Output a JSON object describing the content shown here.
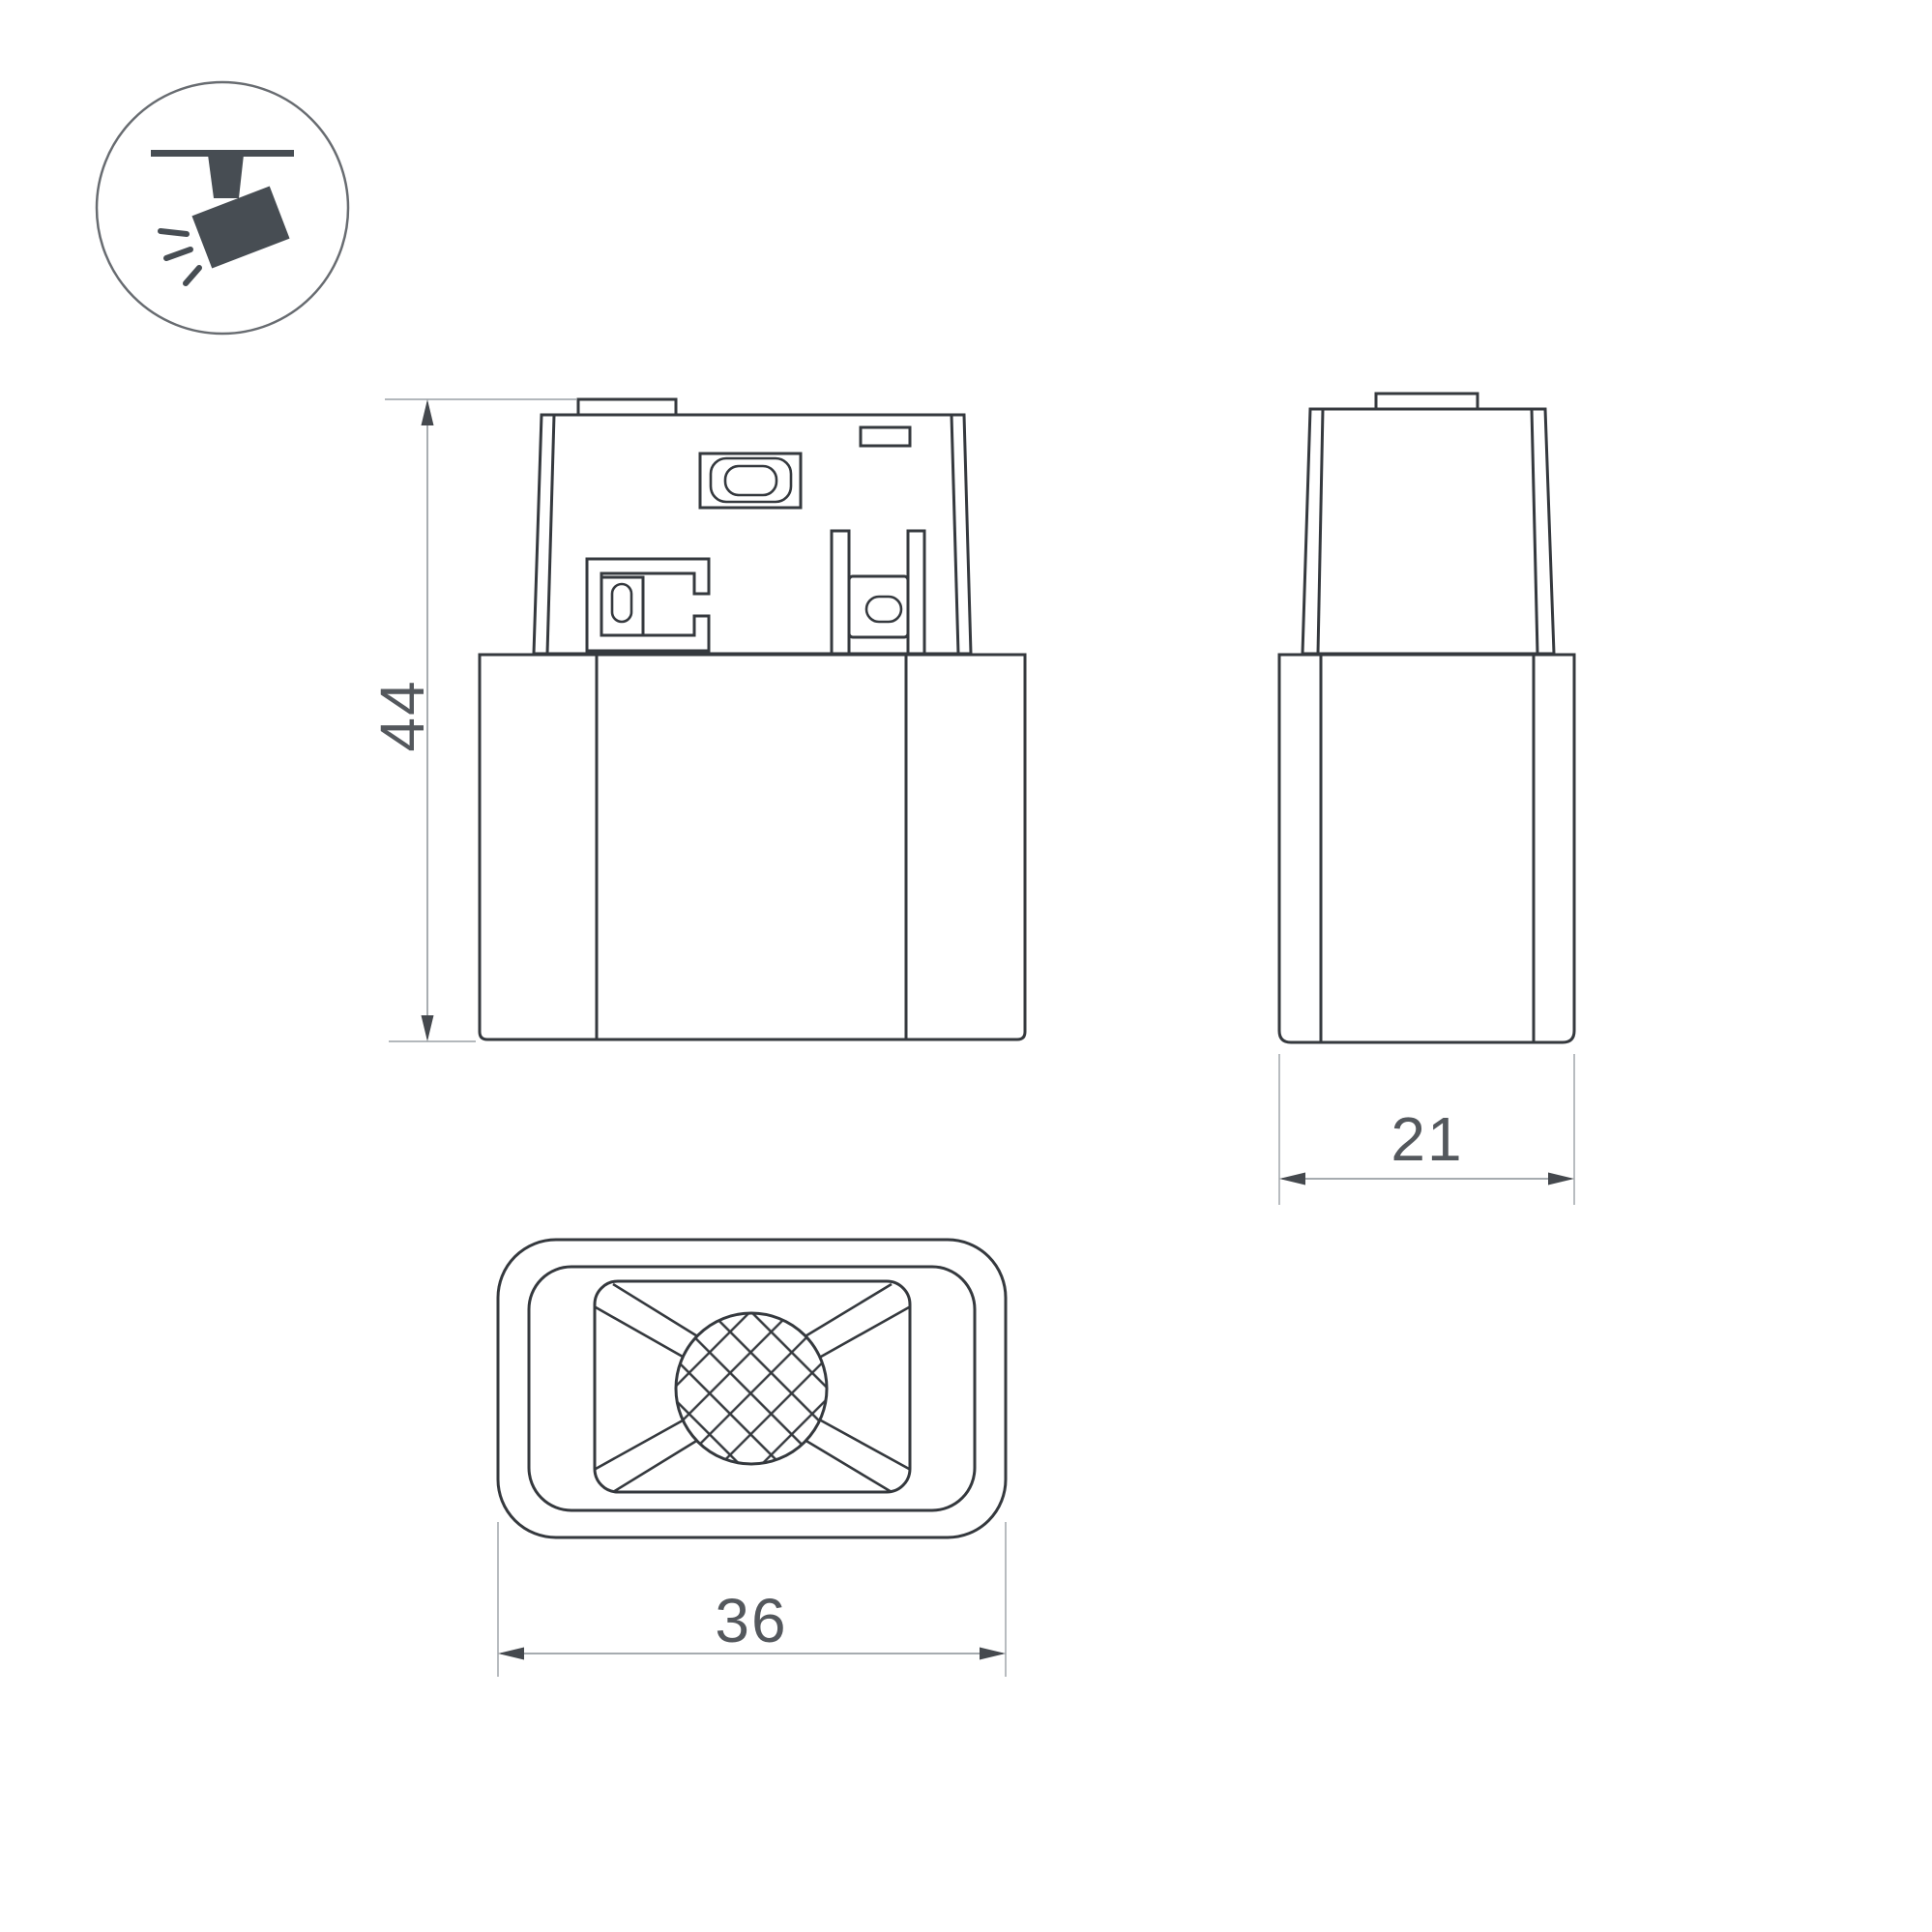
{
  "colors": {
    "object_line": "#35393e",
    "dim_line": "#9aa0a5",
    "arrow": "#45494e",
    "text": "#54585d",
    "icon": "#474d53",
    "icon_outline": "#686c71",
    "background": "#ffffff"
  },
  "icon": {
    "label": "track-spotlight"
  },
  "dimensions": {
    "height": "44",
    "depth": "21",
    "width": "36"
  }
}
